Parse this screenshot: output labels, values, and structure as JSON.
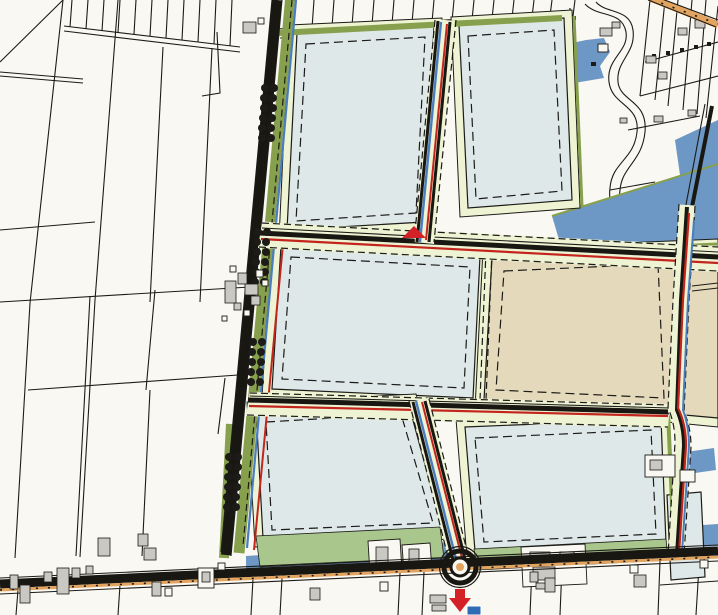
{
  "map": {
    "kind": "zoning-development-plan",
    "orientation_tilt_deg": -4,
    "colors": {
      "background": "#faf8f2",
      "parcel_line": "#1c1b17",
      "block_fill": "#dee8e9",
      "block_margin": "#eef3d3",
      "green_verge": "#87a04d",
      "green_light": "#a9c68d",
      "water": "#6d97c4",
      "water_line": "#4a7cc0",
      "red_line": "#c3251d",
      "road_dark": "#191712",
      "road_accent": "#e2a45f",
      "tan_zone": "#e5d9bc",
      "building_fill": "#c9c8c2",
      "marker_red": "#d42027",
      "marker_blue": "#2e6db6"
    },
    "features": {
      "blocks_light": 6,
      "blocks_tan": 1,
      "tree_rows": 4,
      "roundabout": true,
      "direction_arrow": "down",
      "route_marker": "blue-square"
    }
  }
}
